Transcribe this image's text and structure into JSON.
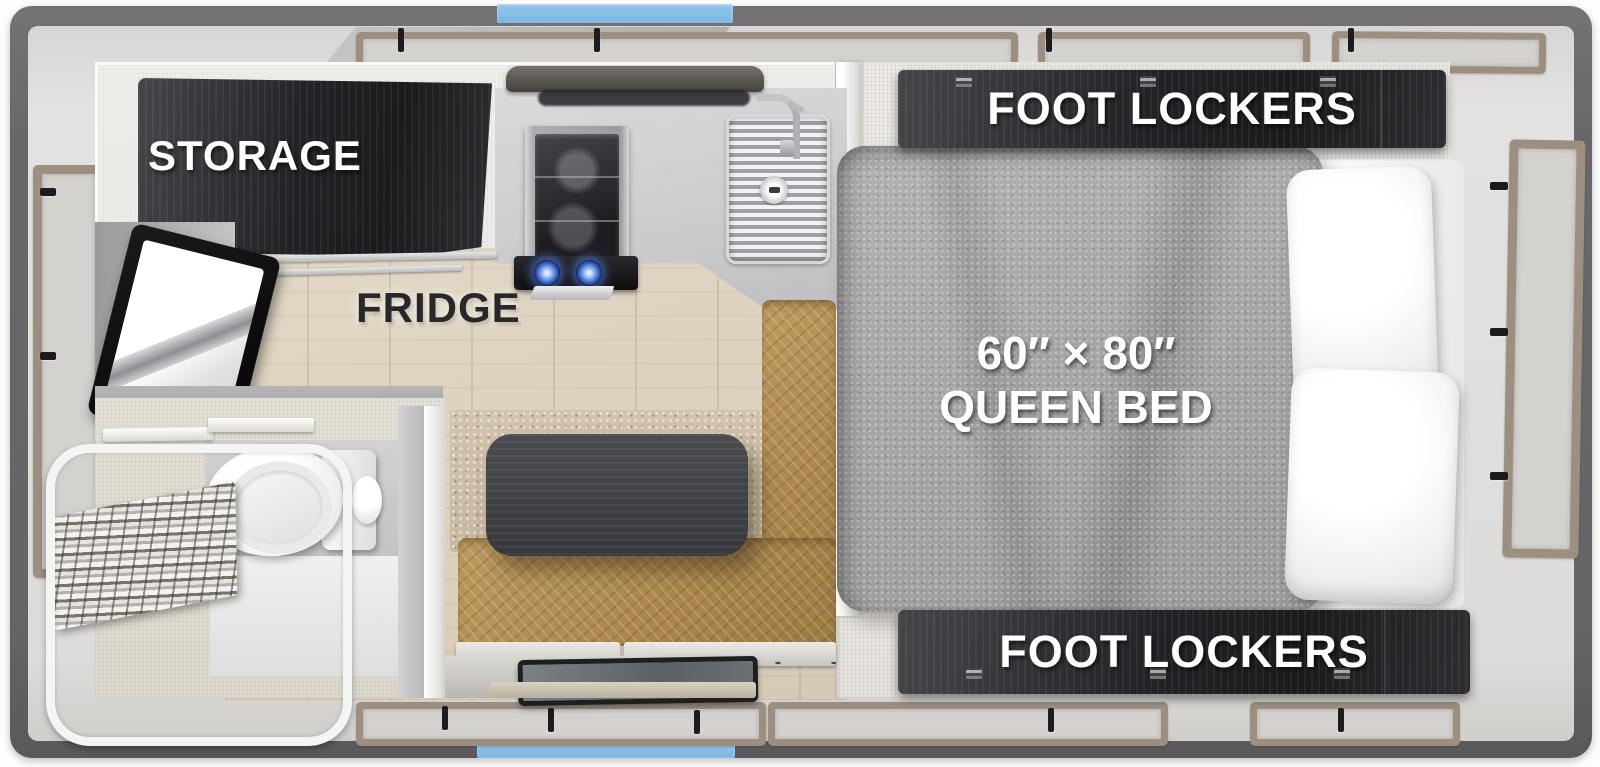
{
  "floorplan": {
    "title_labels": {
      "storage": "STORAGE",
      "fridge": "FRIDGE",
      "foot_lockers_top": "FOOT LOCKERS",
      "foot_lockers_bottom": "FOOT LOCKERS",
      "bed_size": "60″ × 80″",
      "bed_type": "QUEEN BED"
    },
    "fixtures": [
      "storage-cabinet",
      "fridge",
      "tv",
      "range-hood",
      "oven-stove",
      "sink",
      "dinette-table",
      "dinette-bench",
      "entry-door",
      "queen-bed",
      "pillows",
      "foot-lockers-top",
      "foot-lockers-bottom",
      "toilet",
      "shower",
      "accordion-door",
      "canvas-windows"
    ],
    "colors": {
      "shell_gray": "#68686b",
      "accent_blue": "#86bde8",
      "cabinet_dark": "#242428",
      "canvas_frame_tan": "#9d8f80",
      "bench_leather": "#ad8a52",
      "bed_gray": "#a7a7a7",
      "wood_floor": "#dccfba",
      "label_white": "#ffffff",
      "label_dark": "#28282a"
    }
  }
}
